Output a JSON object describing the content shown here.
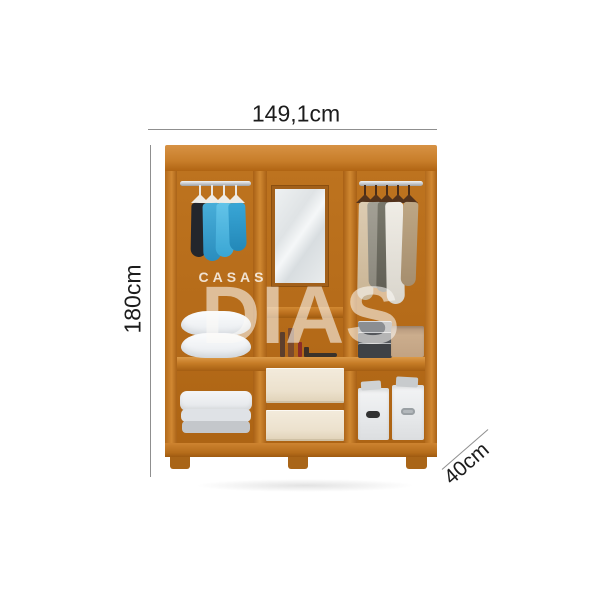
{
  "annotations": {
    "width_label": "149,1cm",
    "height_label": "180cm",
    "depth_label": "40cm"
  },
  "watermark": {
    "line1": "CASAS",
    "line2": "DIAS"
  },
  "colors": {
    "wood_frame": "#c87e2a",
    "wood_interior": "#b56b19",
    "drawer_front": "#ece1cd",
    "dimension_line": "#8f8f8f",
    "annotation_text": "#1c1c1c",
    "watermark_text": "rgba(255,255,255,0.6)",
    "blue_clothes": "#3aa6d4",
    "neutral_clothes": "#d9d5cc"
  },
  "illustration": {
    "type": "wardrobe-product-photo",
    "sections": [
      {
        "name": "left",
        "contents": [
          "hanging-rod",
          "blue-clothes-on-hangers",
          "two-pillows",
          "folded-blanket"
        ]
      },
      {
        "name": "middle",
        "contents": [
          "mirror",
          "cosmetics-shelf",
          "two-drawers"
        ]
      },
      {
        "name": "right",
        "contents": [
          "hanging-rod",
          "neutral-clothes-on-hangers",
          "folded-clothes",
          "tan-box",
          "two-storage-boxes"
        ]
      }
    ]
  }
}
